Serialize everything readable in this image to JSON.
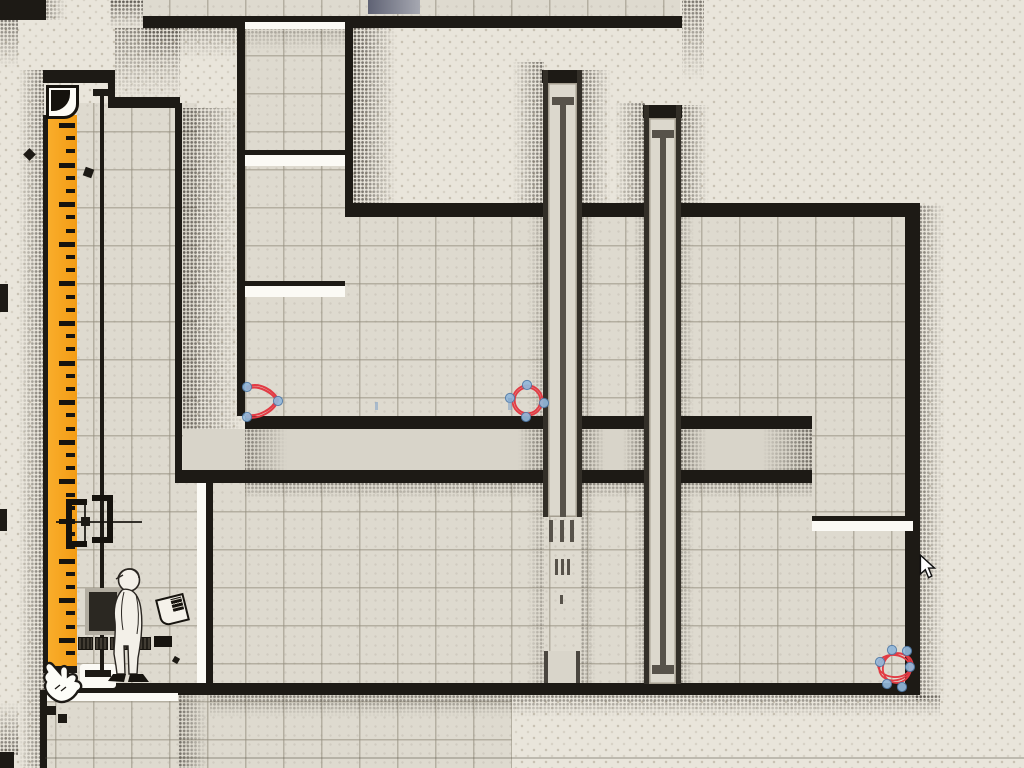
{
  "scene": {
    "kind": "paper-puzzle-game-level",
    "palette": {
      "paper": "#e9e5db",
      "tile": "#dedacf",
      "ink_wall": "#1d1a15",
      "ruler_orange": "#f6a21c",
      "shaft_column": "#dcd8cd",
      "rod_brown": "#57524a",
      "annotation_red": "#e23b44",
      "handle_fill": "#93b8da",
      "handle_stroke": "#507aa8",
      "slate_block": "#696c7c"
    }
  },
  "ruler": {
    "ticks_start": 123,
    "ticks_end": 664,
    "tick_spacing": 13.2,
    "long_every": 3
  },
  "annotations": {
    "stroke": "#e23b44",
    "handle_fill": "#93b8da",
    "handle_stroke": "#507aa8",
    "marks": [
      {
        "name": "pen-curve",
        "paths": [
          "M247,387 C259,381 275,391 278,400 C275,411 259,420 247,417",
          "M247,389 C258,384 273,393 276,400 C273,409 258,417 247,415"
        ],
        "points": [
          [
            247,
            387
          ],
          [
            278,
            401
          ],
          [
            247,
            417
          ]
        ]
      },
      {
        "name": "pen-circle",
        "circles": [
          [
            527.5,
            400.5,
            15
          ],
          [
            527.5,
            400.5,
            12.8
          ]
        ],
        "points": [
          [
            527,
            385
          ],
          [
            544,
            403
          ],
          [
            526,
            417
          ],
          [
            510,
            398
          ]
        ]
      },
      {
        "name": "pen-scribble",
        "ellipses": [
          [
            896,
            667,
            17,
            13,
            -18
          ],
          [
            897,
            668,
            14,
            15,
            22
          ],
          [
            894,
            666,
            16,
            11,
            6
          ]
        ],
        "points": [
          [
            892,
            650
          ],
          [
            907,
            651
          ],
          [
            880,
            662
          ],
          [
            910,
            667
          ],
          [
            887,
            684
          ],
          [
            902,
            687
          ]
        ]
      }
    ],
    "faint_ticks": [
      [
        375,
        402,
        3,
        8
      ],
      [
        508,
        398,
        4,
        12
      ]
    ]
  },
  "shaft1_dashes": {
    "groups": [
      {
        "y": 520,
        "h": 22,
        "w": 4,
        "xs": [
          549,
          560,
          570
        ]
      },
      {
        "y": 559,
        "h": 16,
        "w": 3,
        "xs": [
          555,
          561,
          567
        ]
      },
      {
        "y": 595,
        "h": 9,
        "w": 3,
        "xs": [
          560
        ]
      }
    ]
  },
  "microtext": {
    "chip_widths": [
      13,
      11,
      9,
      12,
      10
    ],
    "tag_width": 18
  }
}
